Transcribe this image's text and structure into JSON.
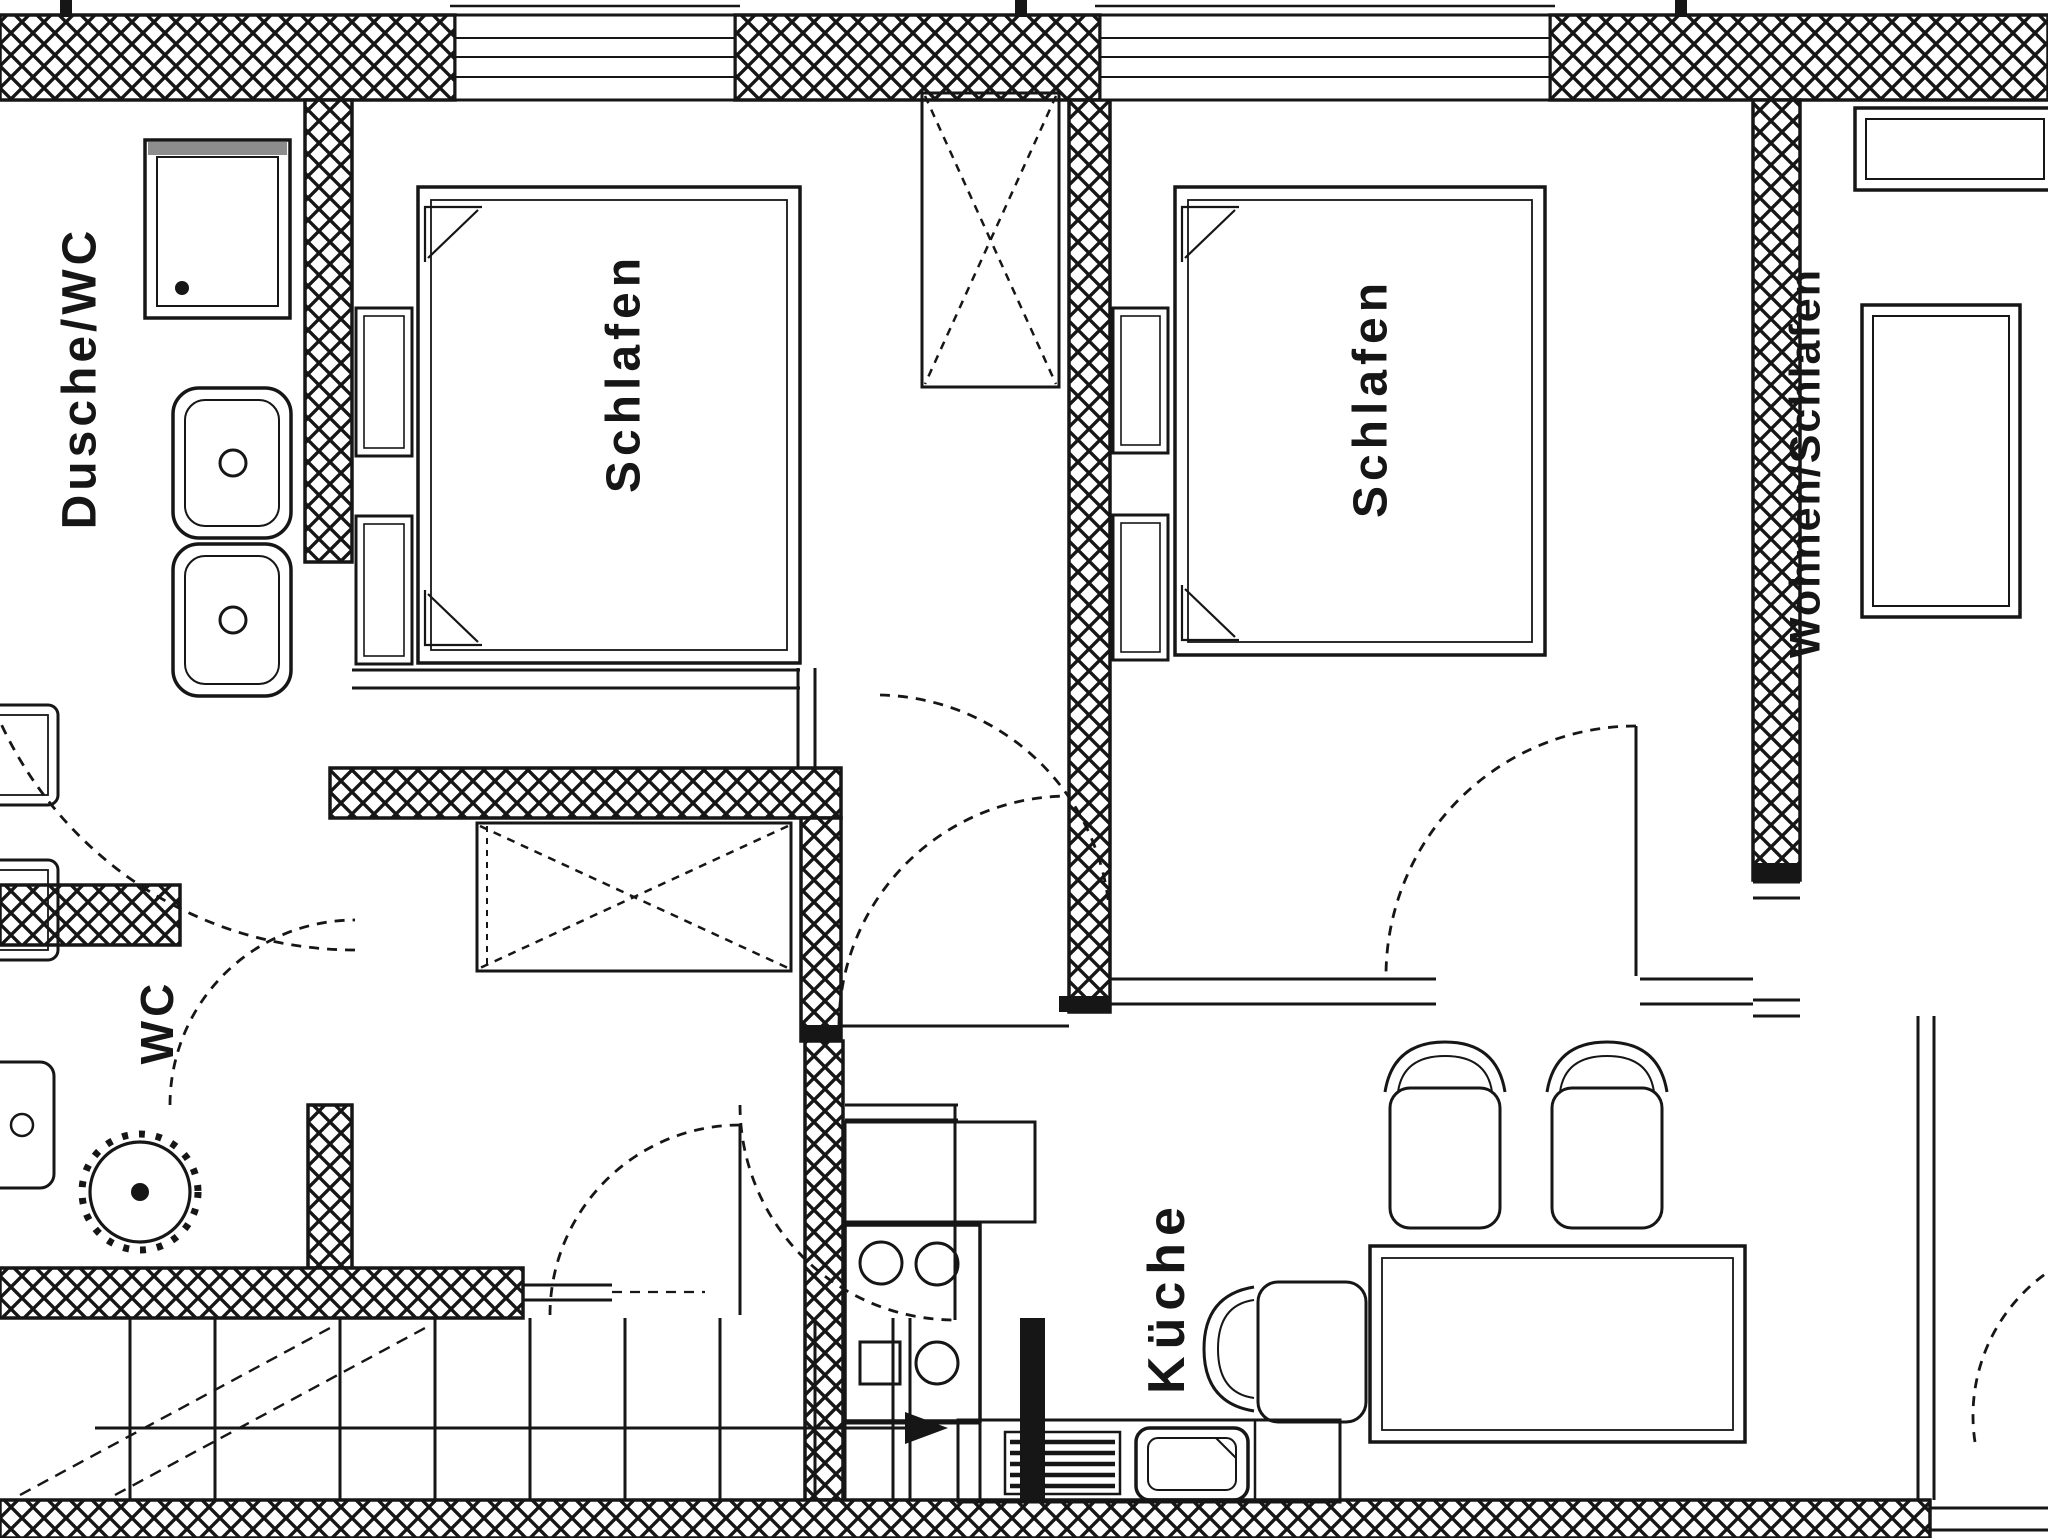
{
  "colors": {
    "ink": "#161616",
    "paper": "#ffffff"
  },
  "rooms": {
    "bathroom": {
      "label": "Dusche/WC"
    },
    "bedroom1": {
      "label": "Schlafen"
    },
    "bedroom2": {
      "label": "Schlafen"
    },
    "living": {
      "label": "Wohnen/Schlafen"
    },
    "wc": {
      "label": "WC"
    },
    "kitchen": {
      "label": "Küche"
    }
  },
  "fixtures": {
    "bathroom": [
      "shower-tray",
      "double-washbasin"
    ],
    "wc": [
      "toilet",
      "hand-basin"
    ],
    "kitchen": [
      "stove-4-burners",
      "sink",
      "dish-rack",
      "counter"
    ],
    "bedroom1": [
      "double-bed",
      "nightstand",
      "nightstand",
      "wardrobe-x"
    ],
    "bedroom2": [
      "bed",
      "nightstand",
      "nightstand"
    ],
    "hall": [
      "wardrobe-x",
      "door-swings"
    ],
    "living": [
      "dining-table",
      "chair",
      "chair",
      "chair",
      "sofa",
      "sideboard"
    ],
    "stairs": [
      "staircase",
      "up-arrow"
    ]
  }
}
